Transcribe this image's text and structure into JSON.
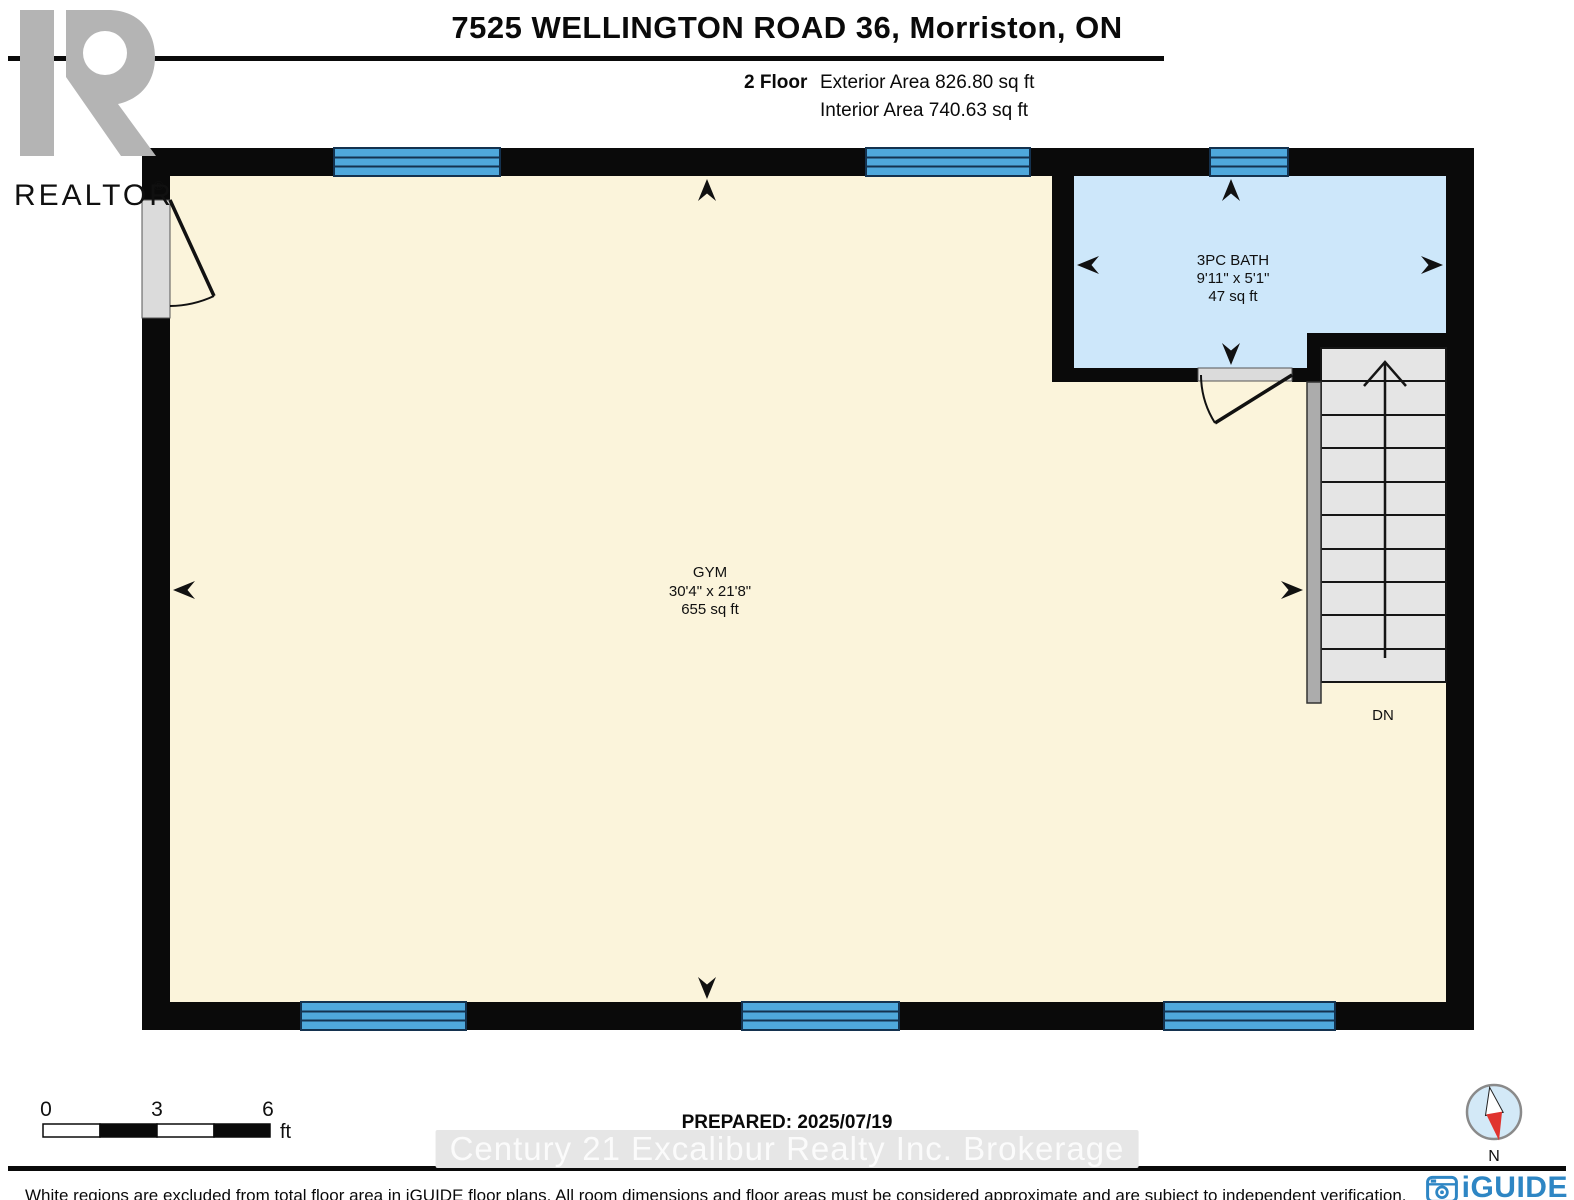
{
  "header": {
    "title": "7525 WELLINGTON ROAD 36, Morriston, ON",
    "floor_label": "2 Floor",
    "exterior_area": "Exterior Area 826.80 sq ft",
    "interior_area": "Interior Area 740.63 sq ft"
  },
  "realtor_logo": {
    "brand": "REALTOR",
    "registered": "®"
  },
  "floorplan": {
    "rooms": [
      {
        "name": "GYM",
        "dimensions": "30'4\" x 21'8\"",
        "area": "655 sq ft"
      },
      {
        "name": "3PC BATH",
        "dimensions": "9'11\" x 5'1\"",
        "area": "47 sq ft"
      }
    ],
    "stairs_label": "DN"
  },
  "scale_bar": {
    "ticks": [
      "0",
      "3",
      "6"
    ],
    "unit": "ft"
  },
  "footer": {
    "prepared": "PREPARED: 2025/07/19",
    "watermark": "Century 21 Excalibur Realty Inc. Brokerage",
    "disclaimer": "White regions are excluded from total floor area in iGUIDE floor plans. All room dimensions and floor areas must be considered approximate and are subject to independent verification.",
    "compass_label": "N",
    "brand": "iGUIDE"
  },
  "colors": {
    "wall": "#0a0a0a",
    "floor": "#FBF4DB",
    "bath_floor": "#CDE7FA",
    "window": "#4FA8DC",
    "window_line": "#14324F",
    "stair_tread": "#E5E5E5",
    "railing": "#ACACAC",
    "door_sill": "#DBDBDB",
    "iguide_blue": "#2E86C4",
    "compass_red": "#E0332E",
    "realtor_gray": "#B4B4B4"
  }
}
